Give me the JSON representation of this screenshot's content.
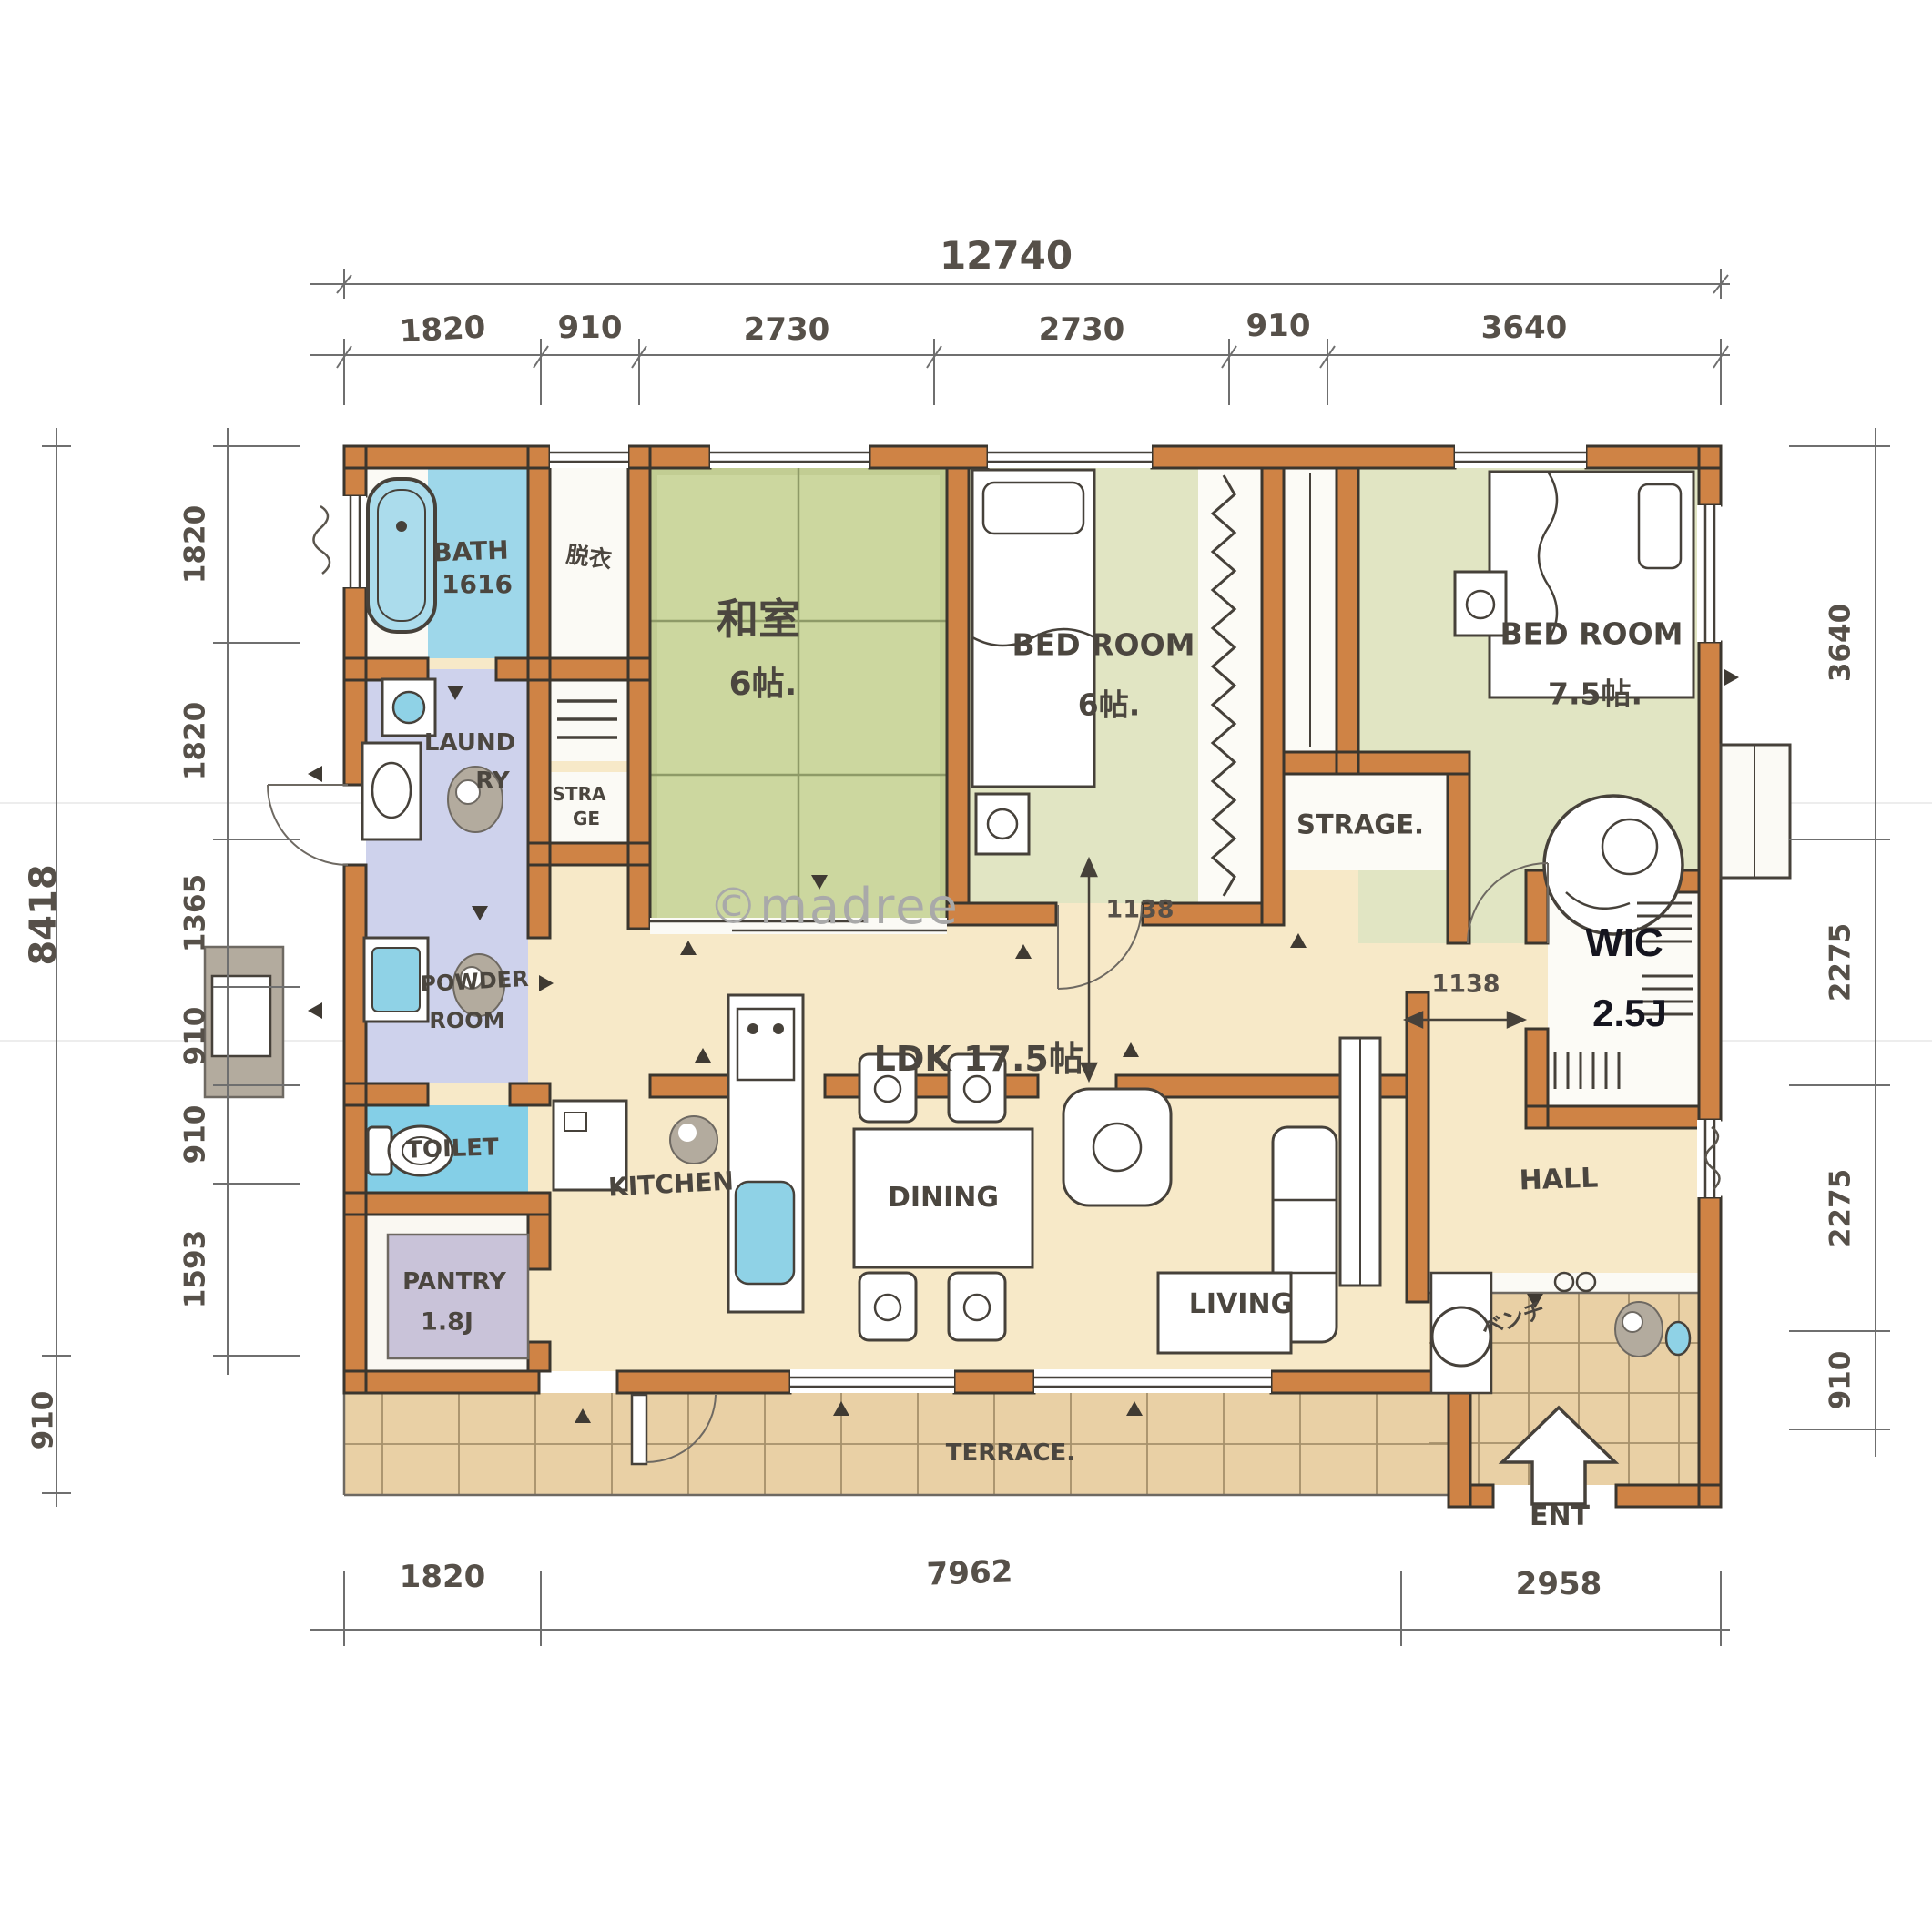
{
  "watermark": "©madree",
  "colors": {
    "wall": "#cf8345",
    "outline": "#3b362e",
    "tatami": "#ccd79f",
    "bedroom_tint": "#e1e5c3",
    "floor": "#f7e9c8",
    "terrace": "#e9d0a5",
    "laundry_floor": "#ced2ec",
    "water_blue": "#8fd2e6",
    "pencil": "#6f6f6f"
  },
  "dimensions": {
    "top_total": "12740",
    "top": [
      "1820",
      "910",
      "2730",
      "2730",
      "910",
      "3640"
    ],
    "left_total": "8418",
    "left": [
      "1820",
      "1820",
      "1365",
      "910",
      "910",
      "1593"
    ],
    "left_outer_bottom": "910",
    "right": [
      "3640",
      "2275",
      "2275",
      "910"
    ],
    "bottom": [
      "1820",
      "7962",
      "2958"
    ],
    "interior": [
      "1138",
      "1138"
    ]
  },
  "rooms": {
    "bath": {
      "name": "BATH",
      "size": "1616"
    },
    "dressing": "脱衣",
    "laundry": {
      "line1": "LAUND",
      "line2": "RY"
    },
    "storage_small": {
      "line1": "STRA",
      "line2": "GE"
    },
    "powder": {
      "line1": "POWDER",
      "line2": "ROOM"
    },
    "toilet": "TOILET",
    "pantry": {
      "name": "PANTRY",
      "size": "1.8J"
    },
    "washitsu": {
      "name": "和室",
      "size": "6帖."
    },
    "bedroom_center": {
      "name": "BED ROOM",
      "size": "6帖."
    },
    "bedroom_right": {
      "name": "BED ROOM",
      "size": "7.5帖."
    },
    "storage_center": "STRAGE.",
    "wic": {
      "name": "WIC",
      "size": "2.5J"
    },
    "ldk": "LDK 17.5帖.",
    "kitchen": "KITCHEN",
    "dining": "DINING",
    "living": "LIVING",
    "hall": "HALL",
    "bench": "ベンチ",
    "entrance": "ENT",
    "terrace": "TERRACE."
  }
}
